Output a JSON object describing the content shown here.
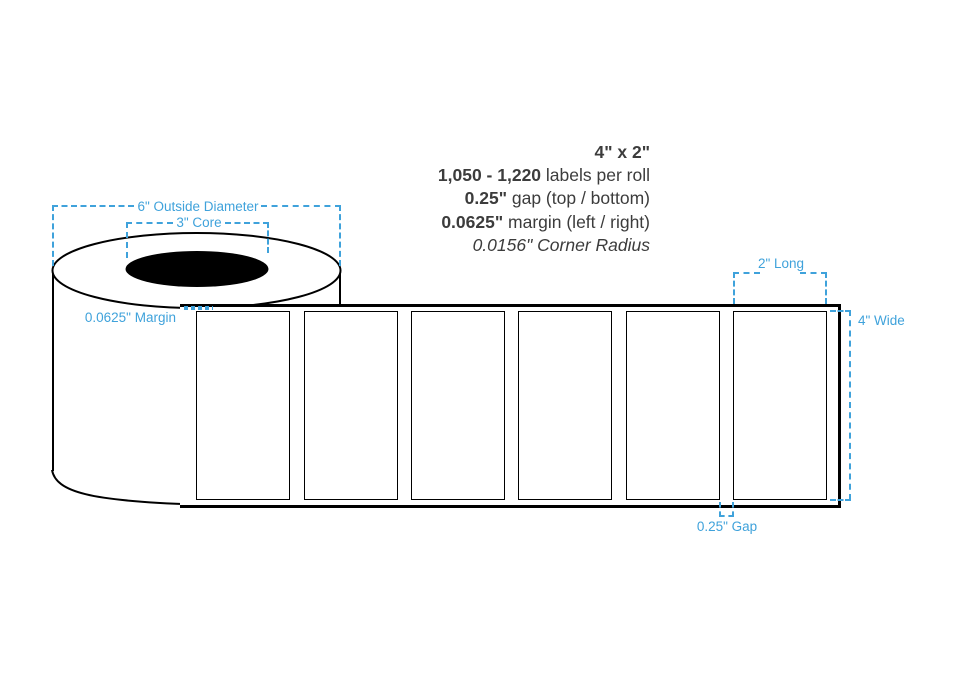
{
  "colors": {
    "accent_blue": "#3FA2DB",
    "line_black": "#000000",
    "text_dark": "#3C3C3C"
  },
  "specs": {
    "size": "4\" x 2\"",
    "labels_line": {
      "bold": "1,050 - 1,220",
      "rest": " labels per roll"
    },
    "gap_line": {
      "bold": "0.25\"",
      "rest": " gap (top / bottom)"
    },
    "margin_line": {
      "bold": "0.0625\"",
      "rest": " margin (left / right)"
    },
    "corner_radius": "0.0156\" Corner Radius"
  },
  "dimensions": {
    "outside_diameter": "6\" Outside Diameter",
    "core": "3\" Core",
    "margin": "0.0625\" Margin",
    "long": "2\" Long",
    "wide": "4\" Wide",
    "gap": "0.25\" Gap"
  },
  "roll": {
    "label_count": 6
  }
}
